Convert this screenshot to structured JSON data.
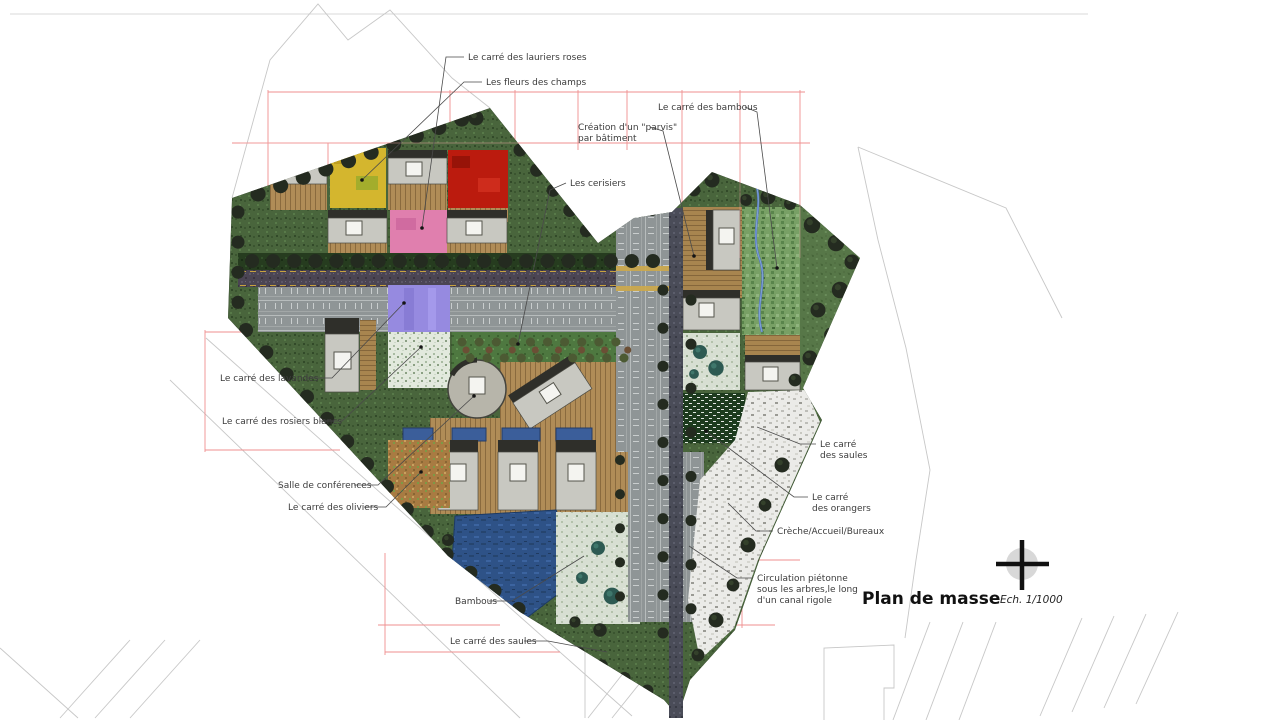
{
  "document": {
    "title": "Plan de masse",
    "scale": "Ech. 1/1000"
  },
  "annotations": {
    "lauriers_roses": "Le carré des lauriers roses",
    "fleurs_des_champs": "Les fleurs des champs",
    "bambous_haut": "Le carré des bambous",
    "parvis_line1": "Création d'un \"parvis\"",
    "parvis_line2": "par bâtiment",
    "cerisiers": "Les cerisiers",
    "lavandes": "Le carré des lavandes",
    "rosiers_blancs": "Le carré des rosiers blancs",
    "salle_conferences": "Salle de conférences",
    "oliviers": "Le carré des oliviers",
    "saules_droite_line1": "Le carré",
    "saules_droite_line2": "des saules",
    "orangers_line1": "Le carré",
    "orangers_line2": "des orangers",
    "creche": "Crèche/Accueil/Bureaux",
    "circulation_line1": "Circulation piétonne",
    "circulation_line2": "sous les arbres,le long",
    "circulation_line3": "d'un canal rigole",
    "bambous_bas": "Bambous",
    "saules_bas": "Le carré des saules"
  },
  "icons": {
    "north_indicator": "north-cross"
  },
  "colors": {
    "grid_red": "#ef8f8f",
    "context_gray": "#c7c7c7",
    "lawn_green": "#49653c",
    "square_fleurs_jaune": "#d4b62e",
    "square_rouge": "#bb1b0e",
    "square_lauriers_rose": "#e07fae",
    "square_lavande_violet": "#968ae0",
    "square_rosiers_blanc": "#e2e9dd",
    "square_oliviers_ocre": "#a87b42",
    "square_orangers_vert": "#1d3b1e",
    "eau_bleu": "#2e5287",
    "bois_deck": "#b08c57",
    "parking_gris": "#8f9596",
    "batiment_gris": "#c8c8c1"
  }
}
